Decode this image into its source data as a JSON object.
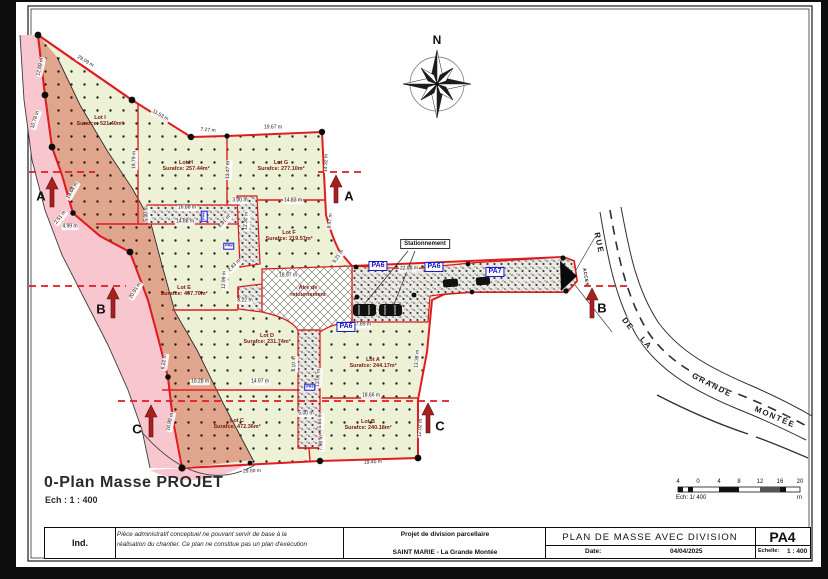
{
  "plan": {
    "title": "0-Plan Masse PROJET",
    "scale": "Ech : 1 : 400",
    "north_label": "N",
    "parking_label": "Stationnement",
    "turnaround_label_1": "Aire de",
    "turnaround_label_2": "retournement",
    "access_label": "ACCES"
  },
  "lots": [
    {
      "name": "Lot I",
      "surface": "Surafce: 521.40m²",
      "x": 100,
      "y": 121
    },
    {
      "name": "Lot H",
      "surface": "Surafce: 257.44m²",
      "x": 186,
      "y": 166
    },
    {
      "name": "Lot G",
      "surface": "Surafce: 277.10m²",
      "x": 281,
      "y": 166
    },
    {
      "name": "Lot F",
      "surface": "Surafce: 219.57m²",
      "x": 289,
      "y": 236
    },
    {
      "name": "Lot E",
      "surface": "Surafce: 467.70m²",
      "x": 184,
      "y": 291
    },
    {
      "name": "Lot D",
      "surface": "Surafce: 231.74m²",
      "x": 267,
      "y": 339
    },
    {
      "name": "Lot C",
      "surface": "Surafce: 472.36m²",
      "x": 237,
      "y": 424
    },
    {
      "name": "Lot B",
      "surface": "Surafce: 240.18m²",
      "x": 368,
      "y": 425
    },
    {
      "name": "Lot A",
      "surface": "Surafce: 244.17m²",
      "x": 373,
      "y": 363
    }
  ],
  "pa_markers": [
    {
      "t": "PA6",
      "x": 378,
      "y": 266,
      "s": 1,
      "r": 0
    },
    {
      "t": "PA6",
      "x": 434,
      "y": 267,
      "s": 1,
      "r": 0
    },
    {
      "t": "PA7",
      "x": 495,
      "y": 272,
      "s": 1,
      "r": 0
    },
    {
      "t": "PA6",
      "x": 346,
      "y": 327,
      "s": 1,
      "r": 0
    },
    {
      "t": "PA6",
      "x": 310,
      "y": 387,
      "s": 0,
      "r": 0
    },
    {
      "t": "PA6",
      "x": 204,
      "y": 216,
      "s": 0,
      "r": -90
    },
    {
      "t": "PA6",
      "x": 229,
      "y": 246,
      "s": 0,
      "r": 0
    }
  ],
  "dimensions": [
    {
      "t": "12.69 m",
      "x": 41,
      "y": 67,
      "r": -78
    },
    {
      "t": "29.09 m",
      "x": 85,
      "y": 62,
      "r": 31
    },
    {
      "t": "11.53 m",
      "x": 160,
      "y": 116,
      "r": 30
    },
    {
      "t": "7.27 m",
      "x": 208,
      "y": 131,
      "r": 5
    },
    {
      "t": "19.67 m",
      "x": 273,
      "y": 128,
      "r": 0
    },
    {
      "t": "19.79 m",
      "x": 135,
      "y": 160,
      "r": -89
    },
    {
      "t": "13.47 m",
      "x": 229,
      "y": 170,
      "r": -88
    },
    {
      "t": "10.78 m",
      "x": 36,
      "y": 120,
      "r": -72
    },
    {
      "t": "19.64 m",
      "x": 73,
      "y": 191,
      "r": -60
    },
    {
      "t": "2.51 m",
      "x": 61,
      "y": 218,
      "r": -52
    },
    {
      "t": "4.99 m",
      "x": 70,
      "y": 227,
      "r": 0
    },
    {
      "t": "20.91 m",
      "x": 136,
      "y": 291,
      "r": -58
    },
    {
      "t": "6.22 m",
      "x": 165,
      "y": 362,
      "r": -82
    },
    {
      "t": "16.99 m",
      "x": 171,
      "y": 422,
      "r": -78
    },
    {
      "t": "16.88 m",
      "x": 187,
      "y": 208,
      "r": 0
    },
    {
      "t": "14.88 m",
      "x": 185,
      "y": 222,
      "r": 0
    },
    {
      "t": "5.00 m",
      "x": 147,
      "y": 214,
      "r": -90
    },
    {
      "t": "3.00 m",
      "x": 240,
      "y": 201,
      "r": 0
    },
    {
      "t": "12.30 m",
      "x": 247,
      "y": 221,
      "r": -87
    },
    {
      "t": "8.91 m",
      "x": 225,
      "y": 222,
      "r": -48
    },
    {
      "t": "14.83 m",
      "x": 293,
      "y": 201,
      "r": 0
    },
    {
      "t": "8.47 m",
      "x": 331,
      "y": 221,
      "r": -83
    },
    {
      "t": "9.21 m",
      "x": 339,
      "y": 257,
      "r": -55
    },
    {
      "t": "14.32 m",
      "x": 327,
      "y": 163,
      "r": -88
    },
    {
      "t": "18.97 m",
      "x": 288,
      "y": 276,
      "r": 0
    },
    {
      "t": "8.22 m",
      "x": 245,
      "y": 301,
      "r": 0
    },
    {
      "t": "12.99 m",
      "x": 225,
      "y": 280,
      "r": -88
    },
    {
      "t": "2.83 m",
      "x": 235,
      "y": 266,
      "r": -45
    },
    {
      "t": "22.88 m",
      "x": 409,
      "y": 269,
      "r": -2
    },
    {
      "t": "17.89 m",
      "x": 362,
      "y": 325,
      "r": 0
    },
    {
      "t": "10.28 m",
      "x": 200,
      "y": 382,
      "r": 0
    },
    {
      "t": "14.97 m",
      "x": 260,
      "y": 382,
      "r": 0
    },
    {
      "t": "8.10 m",
      "x": 295,
      "y": 364,
      "r": -89
    },
    {
      "t": "13.06 m",
      "x": 319,
      "y": 378,
      "r": -86
    },
    {
      "t": "5.00 m",
      "x": 306,
      "y": 414,
      "r": 0
    },
    {
      "t": "5.94 m",
      "x": 321,
      "y": 421,
      "r": -88
    },
    {
      "t": "7.98 m",
      "x": 322,
      "y": 443,
      "r": -88
    },
    {
      "t": "18.66 m",
      "x": 371,
      "y": 396,
      "r": 0
    },
    {
      "t": "13.38 m",
      "x": 418,
      "y": 359,
      "r": -85
    },
    {
      "t": "12.02 m",
      "x": 421,
      "y": 428,
      "r": -85
    },
    {
      "t": "29.00 m",
      "x": 252,
      "y": 472,
      "r": -2
    },
    {
      "t": "19.40 m",
      "x": 373,
      "y": 463,
      "r": -3
    }
  ],
  "sections": [
    {
      "letter": "A",
      "x": 41,
      "y": 196
    },
    {
      "letter": "A",
      "x": 349,
      "y": 196
    },
    {
      "letter": "B",
      "x": 101,
      "y": 309
    },
    {
      "letter": "B",
      "x": 602,
      "y": 308
    },
    {
      "letter": "C",
      "x": 137,
      "y": 429
    },
    {
      "letter": "C",
      "x": 440,
      "y": 426
    }
  ],
  "street_name_words": [
    {
      "t": "RUE",
      "x": 599,
      "y": 243,
      "r": 78
    },
    {
      "t": "DE",
      "x": 628,
      "y": 324,
      "r": 52
    },
    {
      "t": "LA",
      "x": 646,
      "y": 343,
      "r": 48
    },
    {
      "t": "GRANDE",
      "x": 712,
      "y": 385,
      "r": 27
    },
    {
      "t": "MONTÉE",
      "x": 775,
      "y": 417,
      "r": 23
    }
  ],
  "road_texts": [
    {
      "t": "servitude",
      "x": 404,
      "y": 287,
      "r": 4
    },
    {
      "t": "passage",
      "x": 524,
      "y": 281,
      "r": -8
    }
  ],
  "scalebar": {
    "ticks": [
      {
        "t": "4",
        "x": 678
      },
      {
        "t": "0",
        "x": 698
      },
      {
        "t": "4",
        "x": 719
      },
      {
        "t": "8",
        "x": 739
      },
      {
        "t": "12",
        "x": 760
      },
      {
        "t": "16",
        "x": 780
      },
      {
        "t": "20",
        "x": 800
      }
    ],
    "caption": "Ech: 1/  400",
    "unit": "m"
  },
  "titleblock": {
    "ind": "Ind.",
    "disclaimer_line1": "Pièce administratif conceptuel ne pouvant servir de base à la",
    "disclaimer_line2": "réalisation du chantier. Ce plan ne constitue pas un plan d'exécution",
    "project_line1": "Projet de division parcellaire",
    "project_line2": "SAINT MARIE - La Grande Montée",
    "doc_title": "PLAN DE MASSE AVEC DIVISION",
    "date_label": "Date:",
    "date_value": "04/04/2025",
    "sheet_code": "PA4",
    "scale_label": "Echelle:",
    "scale_value": "1 : 400"
  },
  "colors": {
    "boundary_red": "#e11b22",
    "lot_green": "#edf2d7",
    "overlay_tan": "#e0a68d",
    "road_pink": "#f7c6ce",
    "pa_blue": "#1518c8",
    "lot_text": "#7a190e",
    "section_arrow": "#a81f1f"
  }
}
